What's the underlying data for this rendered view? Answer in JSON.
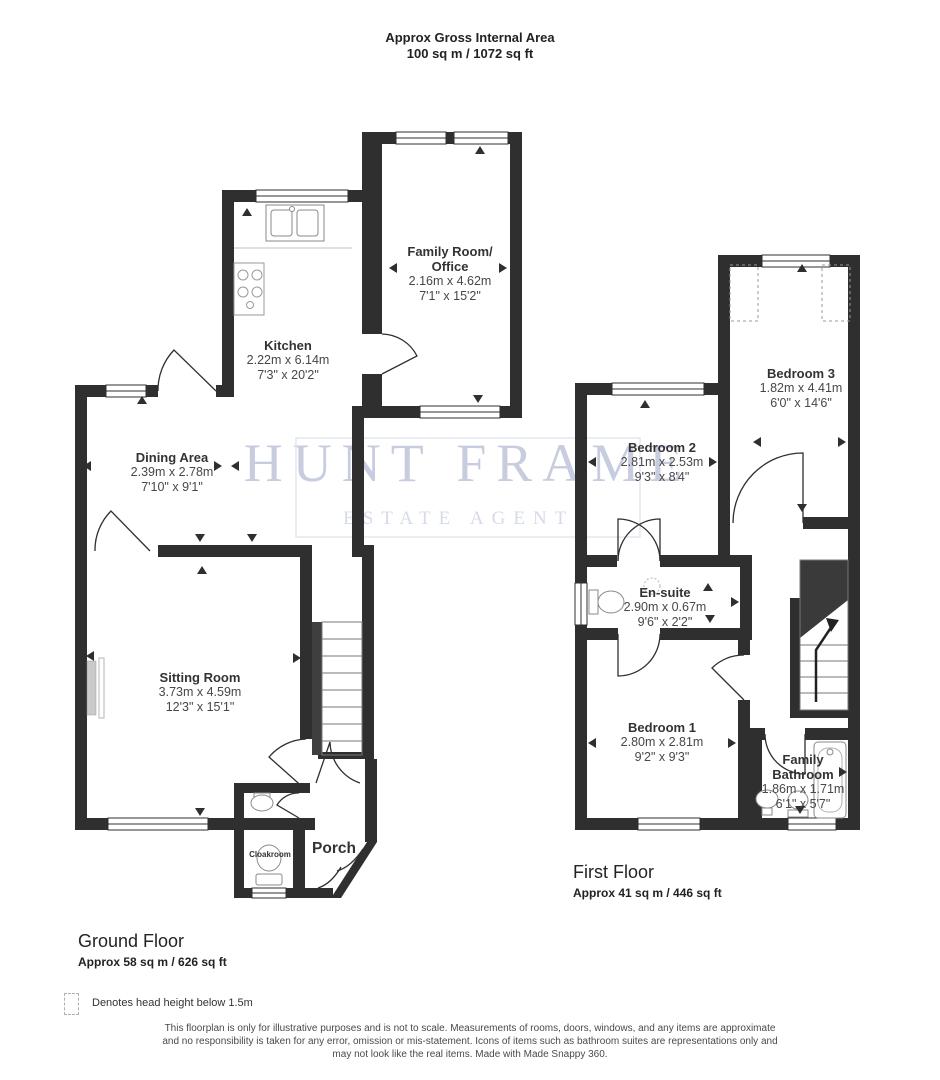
{
  "title": {
    "line1": "Approx Gross Internal Area",
    "line2": "100 sq m / 1072 sq ft"
  },
  "watermark": {
    "name": "HUNT FRAME",
    "tagline": "ESTATE AGENTS"
  },
  "ground_floor": {
    "heading": "Ground Floor",
    "area": "Approx 58 sq m / 626 sq ft",
    "rooms": {
      "kitchen": {
        "name": "Kitchen",
        "metric": "2.22m x 6.14m",
        "imperial": "7'3\" x 20'2\""
      },
      "family_room": {
        "name": "Family Room/\nOffice",
        "metric": "2.16m x 4.62m",
        "imperial": "7'1\" x 15'2\""
      },
      "dining": {
        "name": "Dining Area",
        "metric": "2.39m x 2.78m",
        "imperial": "7'10\" x 9'1\""
      },
      "sitting": {
        "name": "Sitting Room",
        "metric": "3.73m x 4.59m",
        "imperial": "12'3\" x 15'1\""
      },
      "cloakroom": {
        "name": "Cloakroom"
      },
      "porch": {
        "name": "Porch"
      }
    }
  },
  "first_floor": {
    "heading": "First Floor",
    "area": "Approx 41 sq m / 446 sq ft",
    "rooms": {
      "bedroom2": {
        "name": "Bedroom 2",
        "metric": "2.81m x 2.53m",
        "imperial": "9'3\" x 8'4\""
      },
      "bedroom3": {
        "name": "Bedroom 3",
        "metric": "1.82m x 4.41m",
        "imperial": "6'0\" x 14'6\""
      },
      "ensuite": {
        "name": "En-suite",
        "metric": "2.90m x 0.67m",
        "imperial": "9'6\" x 2'2\""
      },
      "bedroom1": {
        "name": "Bedroom 1",
        "metric": "2.80m x 2.81m",
        "imperial": "9'2\" x 9'3\""
      },
      "bathroom": {
        "name": "Family\nBathroom",
        "metric": "1.86m x 1.71m",
        "imperial": "6'1\" x 5'7\""
      }
    }
  },
  "legend": {
    "label": "Denotes head height below 1.5m"
  },
  "disclaimer": "This floorplan is only for illustrative purposes and is not to scale. Measurements of rooms, doors, windows, and any items are approximate\nand no responsibility is taken for any error, omission or mis-statement. Icons of items such as bathroom suites are representations only and\nmay not look like the real items. Made with Made Snappy 360.",
  "colors": {
    "wall": "#2f2f2f",
    "watermark": "#c7cdde"
  }
}
